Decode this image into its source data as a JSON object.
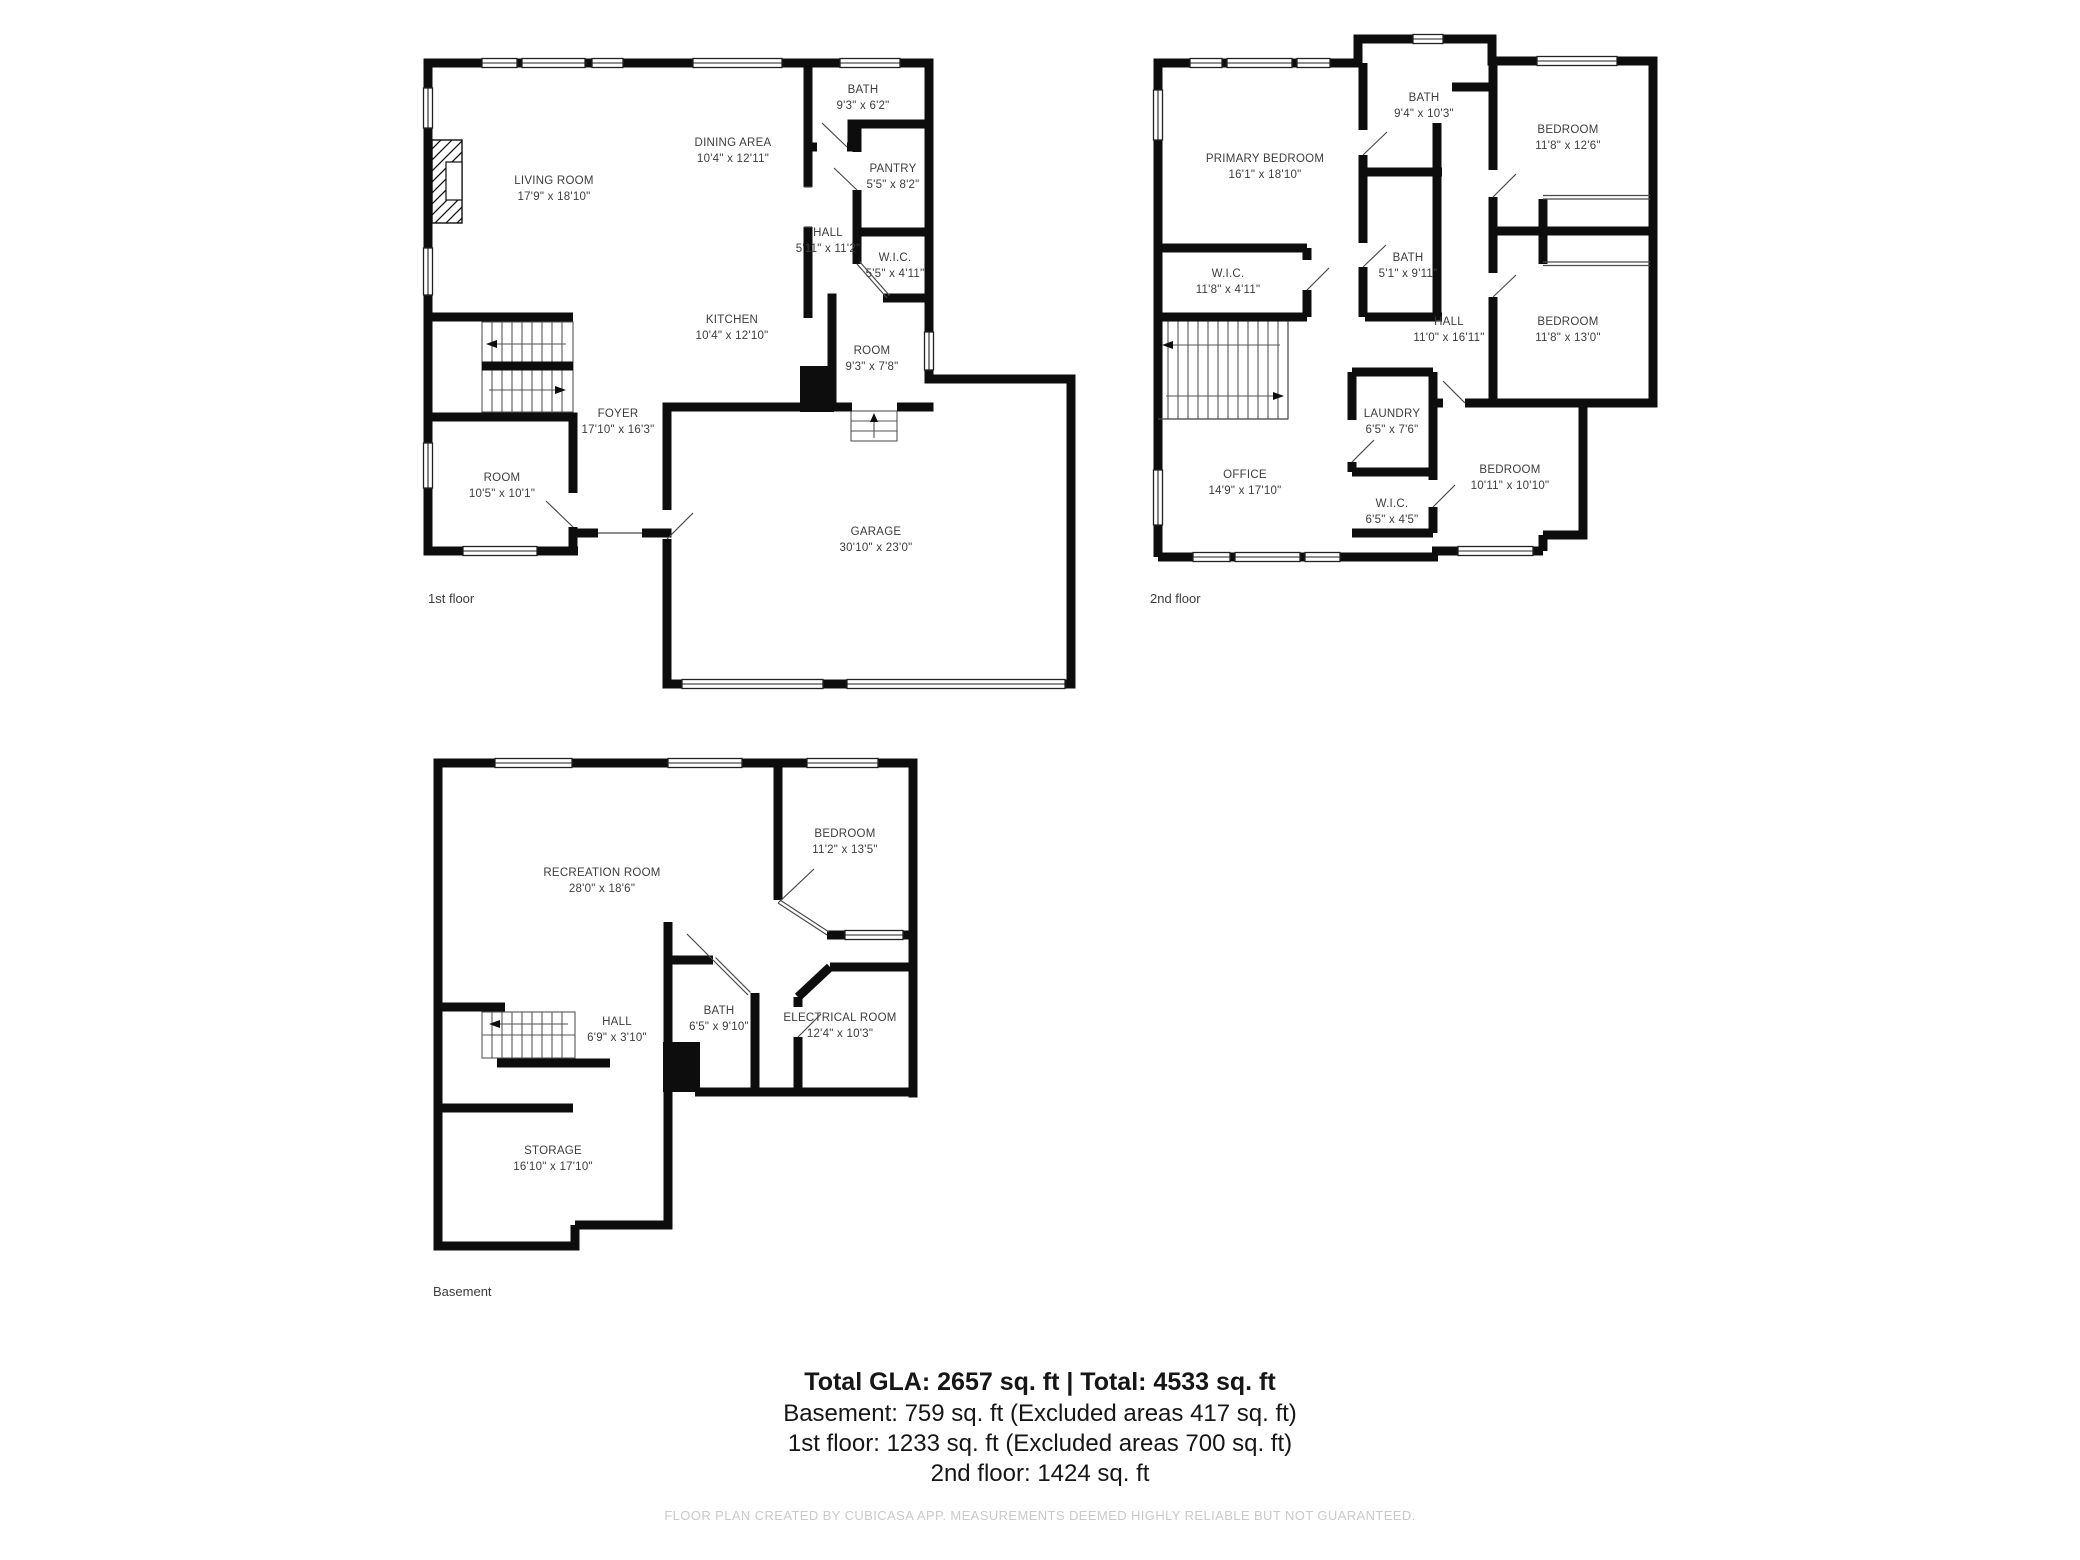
{
  "floors": {
    "floor1": {
      "label": "1st floor",
      "rooms": {
        "living_room": {
          "name": "LIVING ROOM",
          "dims": "17'9\" x 18'10\""
        },
        "dining_area": {
          "name": "DINING AREA",
          "dims": "10'4\" x 12'11\""
        },
        "bath": {
          "name": "BATH",
          "dims": "9'3\" x 6'2\""
        },
        "pantry": {
          "name": "PANTRY",
          "dims": "5'5\" x 8'2\""
        },
        "hall": {
          "name": "HALL",
          "dims": "5'11\" x 11'2\""
        },
        "wic": {
          "name": "W.I.C.",
          "dims": "5'5\" x 4'11\""
        },
        "kitchen": {
          "name": "KITCHEN",
          "dims": "10'4\" x 12'10\""
        },
        "room_upper": {
          "name": "ROOM",
          "dims": "9'3\" x 7'8\""
        },
        "foyer": {
          "name": "FOYER",
          "dims": "17'10\" x 16'3\""
        },
        "room_lower": {
          "name": "ROOM",
          "dims": "10'5\" x 10'1\""
        },
        "garage": {
          "name": "GARAGE",
          "dims": "30'10\" x 23'0\""
        }
      }
    },
    "floor2": {
      "label": "2nd floor",
      "rooms": {
        "primary_bedroom": {
          "name": "PRIMARY BEDROOM",
          "dims": "16'1\" x 18'10\""
        },
        "bath_top": {
          "name": "BATH",
          "dims": "9'4\" x 10'3\""
        },
        "bedroom_tr": {
          "name": "BEDROOM",
          "dims": "11'8\" x 12'6\""
        },
        "wic_left": {
          "name": "W.I.C.",
          "dims": "11'8\" x 4'11\""
        },
        "bath_mid": {
          "name": "BATH",
          "dims": "5'1\" x 9'11\""
        },
        "hall": {
          "name": "HALL",
          "dims": "11'0\" x 16'11\""
        },
        "bedroom_right": {
          "name": "BEDROOM",
          "dims": "11'8\" x 13'0\""
        },
        "laundry": {
          "name": "LAUNDRY",
          "dims": "6'5\" x 7'6\""
        },
        "office": {
          "name": "OFFICE",
          "dims": "14'9\" x 17'10\""
        },
        "wic_small": {
          "name": "W.I.C.",
          "dims": "6'5\" x 4'5\""
        },
        "bedroom_bottom": {
          "name": "BEDROOM",
          "dims": "10'11\" x 10'10\""
        }
      }
    },
    "basement": {
      "label": "Basement",
      "rooms": {
        "recreation": {
          "name": "RECREATION ROOM",
          "dims": "28'0\" x 18'6\""
        },
        "bedroom": {
          "name": "BEDROOM",
          "dims": "11'2\" x 13'5\""
        },
        "hall": {
          "name": "HALL",
          "dims": "6'9\" x 3'10\""
        },
        "bath": {
          "name": "BATH",
          "dims": "6'5\" x 9'10\""
        },
        "electrical": {
          "name": "ELECTRICAL ROOM",
          "dims": "12'4\" x 10'3\""
        },
        "storage": {
          "name": "STORAGE",
          "dims": "16'10\" x 17'10\""
        }
      }
    }
  },
  "summary": {
    "total_line": "Total GLA: 2657 sq. ft | Total: 4533 sq. ft",
    "basement_line": "Basement: 759 sq. ft (Excluded areas 417 sq. ft)",
    "first_line": "1st floor: 1233 sq. ft (Excluded areas 700 sq. ft)",
    "second_line": "2nd floor: 1424 sq. ft"
  },
  "footer": {
    "disclaimer": "FLOOR PLAN CREATED BY CUBICASA APP. MEASUREMENTS DEEMED HIGHLY RELIABLE BUT NOT GUARANTEED."
  },
  "colors": {
    "wall": "#0d0d0d",
    "room_text": "#3d3d3d",
    "summary_text": "#161616",
    "footer_text": "#c9c9c9"
  }
}
